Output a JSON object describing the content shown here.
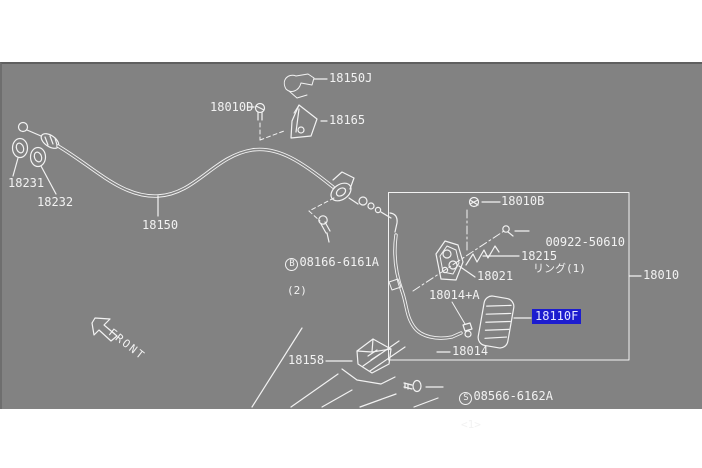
{
  "colors": {
    "panel-bg": "#828282",
    "line": "#f2f2f2",
    "hl-bg": "#1c1ccf",
    "hl-text": "#e3e6ff",
    "page-bg": "#ffffff"
  },
  "diagram": {
    "front_label": "FRONT",
    "highlighted_part": "18110F"
  },
  "parts": {
    "p18150J": {
      "label": "18150J"
    },
    "p18010D": {
      "label": "18010D"
    },
    "p18165": {
      "label": "18165"
    },
    "p18231": {
      "label": "18231"
    },
    "p18232": {
      "label": "18232"
    },
    "p18150": {
      "label": "18150"
    },
    "b08166": {
      "prefix": "B",
      "label": "08166-6161A",
      "qty": "(2)"
    },
    "p18010B": {
      "label": "18010B"
    },
    "p00922": {
      "label": "00922-50610",
      "note": "リング(1)"
    },
    "p18215": {
      "label": "18215"
    },
    "p18021": {
      "label": "18021"
    },
    "p18014A": {
      "label": "18014+A"
    },
    "p18110F": {
      "label": "18110F"
    },
    "p18010": {
      "label": "18010"
    },
    "p18014": {
      "label": "18014"
    },
    "p18158": {
      "label": "18158"
    },
    "s08566": {
      "prefix": "S",
      "label": "08566-6162A",
      "qty": "<1>"
    }
  }
}
